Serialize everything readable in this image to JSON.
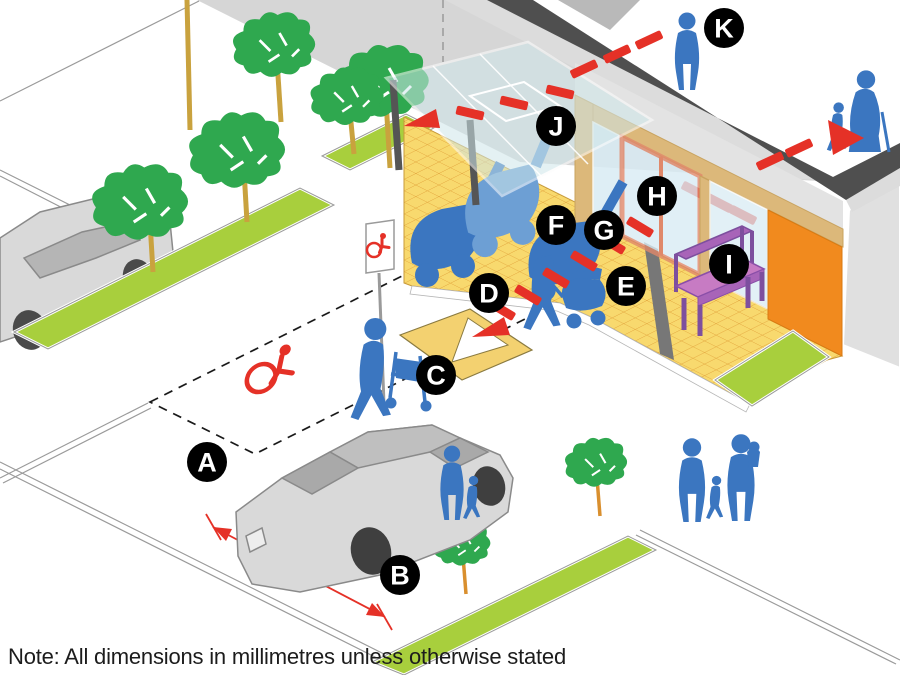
{
  "note_text": "Note: All dimensions in millimetres unless otherwise stated",
  "dimension_label": "3600",
  "callouts": [
    {
      "letter": "A"
    },
    {
      "letter": "B"
    },
    {
      "letter": "C"
    },
    {
      "letter": "D"
    },
    {
      "letter": "E"
    },
    {
      "letter": "F"
    },
    {
      "letter": "G"
    },
    {
      "letter": "H"
    },
    {
      "letter": "I"
    },
    {
      "letter": "J"
    },
    {
      "letter": "K"
    }
  ],
  "icons": {
    "parking_bay_marking": "wheelchair-symbol",
    "parking_sign": "wheelchair-symbol",
    "route_marking": "red-dashed-arrow"
  },
  "colors": {
    "accent_red": "#e53127",
    "people_blue": "#3b76c0",
    "pram_light_blue": "#6d9fd4",
    "footpath_yellow": "#f8d96e",
    "tile_grid_orange": "#e2a43c",
    "planter_green": "#a8cf3d",
    "tree_green": "#2fa84f",
    "trunk_tan": "#c9a23e",
    "canopy_glass": "#cfe7ea",
    "glass_blue": "#d9ecf4",
    "wall_tan": "#dcb87a",
    "door_salmon": "#e0886a",
    "feature_wall_orange": "#f18a1e",
    "bench_purple": "#a864b8",
    "fascia_dark_gray": "#4f4f4f",
    "road_gray": "#d6d6d6",
    "car_gray": "#d9d9d9",
    "callout_black": "#000000"
  }
}
